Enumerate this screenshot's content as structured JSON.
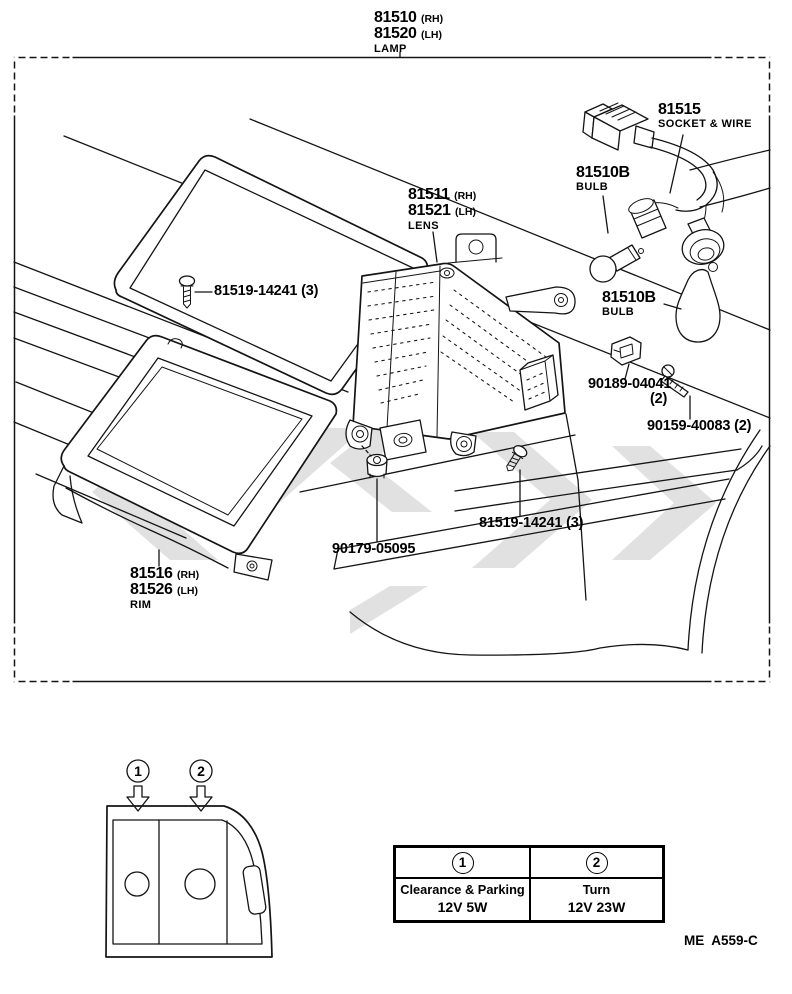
{
  "diagram": {
    "labels": {
      "lamp": {
        "num_rh": "81510",
        "rh": "(RH)",
        "num_lh": "81520",
        "lh": "(LH)",
        "name": "LAMP"
      },
      "socket_wire": {
        "num": "81515",
        "name": "SOCKET & WIRE"
      },
      "bulb_top": {
        "num": "81510B",
        "name": "BULB"
      },
      "lens": {
        "num_rh": "81511",
        "rh": "(RH)",
        "num_lh": "81521",
        "lh": "(LH)",
        "name": "LENS"
      },
      "screw_lens_a": {
        "num": "81519-14241",
        "qty": "(3)"
      },
      "bulb_side": {
        "num": "81510B",
        "name": "BULB"
      },
      "clip": {
        "num": "90189-04041",
        "qty": "(2)"
      },
      "screw_fender": {
        "num": "90159-40083",
        "qty": "(2)"
      },
      "screw_lens_b": {
        "num": "81519-14241",
        "qty": "(3)"
      },
      "grommet": {
        "num": "90179-05095"
      },
      "rim": {
        "num_rh": "81516",
        "rh": "(RH)",
        "num_lh": "81526",
        "lh": "(LH)",
        "name": "RIM"
      }
    },
    "inset": {
      "callout_1": "1",
      "callout_2": "2"
    }
  },
  "table": {
    "columns": [
      {
        "callout": "1",
        "function": "Clearance & Parking",
        "spec": "12V 5W"
      },
      {
        "callout": "2",
        "function": "Turn",
        "spec": "12V 23W"
      }
    ]
  },
  "footer": {
    "code": "ME  A559-C"
  }
}
